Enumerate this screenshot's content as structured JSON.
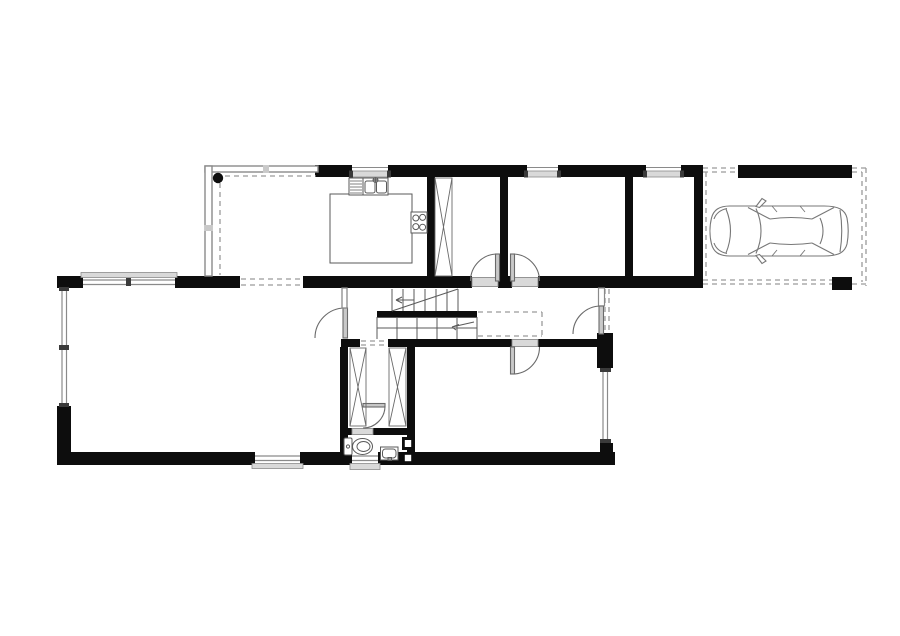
{
  "drawing": {
    "kind": "architectural-floor-plan",
    "floor": "ground-floor",
    "canvas": {
      "width": 900,
      "height": 636
    },
    "colors": {
      "background": "#ffffff",
      "wall": "#0d0d0d",
      "fixture_line": "#555555",
      "thin_line": "#8a8a8a",
      "sill_fill": "#d9d9d9",
      "dashed_line": "#9a9a9a"
    }
  },
  "spaces": [
    {
      "name": "conservatory-dining",
      "walls": "thin-glazed",
      "features": [
        "column-dot",
        "dashed-roof-edge",
        "open-passage-to-living-room"
      ]
    },
    {
      "name": "kitchen",
      "features": [
        "dishwasher",
        "double-sink-with-faucet",
        "counter-island",
        "cooktop-4-burners"
      ]
    },
    {
      "name": "walk-in-closet-room",
      "features": [
        "wardrobe-x-symbol",
        "door-to-hall"
      ]
    },
    {
      "name": "bedroom-center",
      "features": [
        "window-north",
        "door-to-hall"
      ]
    },
    {
      "name": "storage-room-east",
      "features": [
        "window-north"
      ]
    },
    {
      "name": "entrance-hall",
      "features": [
        "entrance-door-east",
        "void-dashed-outline"
      ]
    },
    {
      "name": "staircase",
      "features": [
        "upper-flight",
        "landing-wall",
        "lower-flight",
        "direction-arrows"
      ]
    },
    {
      "name": "living-room",
      "features": [
        "window-north",
        "window-west",
        "window-south",
        "door-to-hall"
      ]
    },
    {
      "name": "corridor",
      "features": [
        "wardrobe-left",
        "wardrobe-right",
        "dashed-opening-north",
        "door-to-wc"
      ]
    },
    {
      "name": "wc",
      "features": [
        "toilet",
        "washbasin",
        "ventilation-shafts",
        "window-south"
      ]
    },
    {
      "name": "bedroom-south-east",
      "features": [
        "door-north",
        "window-east"
      ]
    },
    {
      "name": "carport",
      "features": [
        "car-top-view",
        "dashed-roof-outline",
        "wall-north",
        "post-south-east"
      ]
    }
  ],
  "counts": {
    "doors": 6,
    "windows": 8,
    "wardrobes": 3,
    "stair_flights": 2,
    "cars": 1,
    "columns": 1
  }
}
